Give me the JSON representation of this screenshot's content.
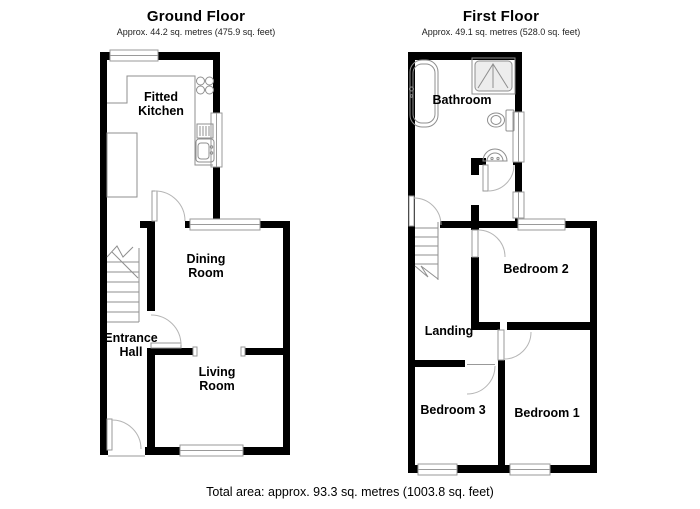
{
  "floors": [
    {
      "title": "Ground Floor",
      "subtitle": "Approx. 44.2 sq. metres (475.9 sq. feet)",
      "rooms": [
        {
          "name": "Fitted Kitchen"
        },
        {
          "name": "Dining Room"
        },
        {
          "name": "Entrance Hall"
        },
        {
          "name": "Living Room"
        }
      ]
    },
    {
      "title": "First Floor",
      "subtitle": "Approx. 49.1 sq. metres (528.0 sq. feet)",
      "rooms": [
        {
          "name": "Bathroom"
        },
        {
          "name": "Landing"
        },
        {
          "name": "Bedroom 2"
        },
        {
          "name": "Bedroom 3"
        },
        {
          "name": "Bedroom 1"
        }
      ]
    }
  ],
  "footer": {
    "total_area": "Total area: approx. 93.3 sq. metres (1003.8 sq. feet)"
  },
  "fixtures": [
    "bathtub",
    "shower",
    "toilet",
    "basin",
    "stairs",
    "hob",
    "sink",
    "drainer",
    "kitchen-counter",
    "kitchen-unit"
  ],
  "colors": {
    "wall": "#000000",
    "window_frame": "#9a9a9a",
    "fixture": "#8f8f8f",
    "door_arc": "#b5b5b5",
    "background": "#ffffff",
    "text": "#000000"
  }
}
